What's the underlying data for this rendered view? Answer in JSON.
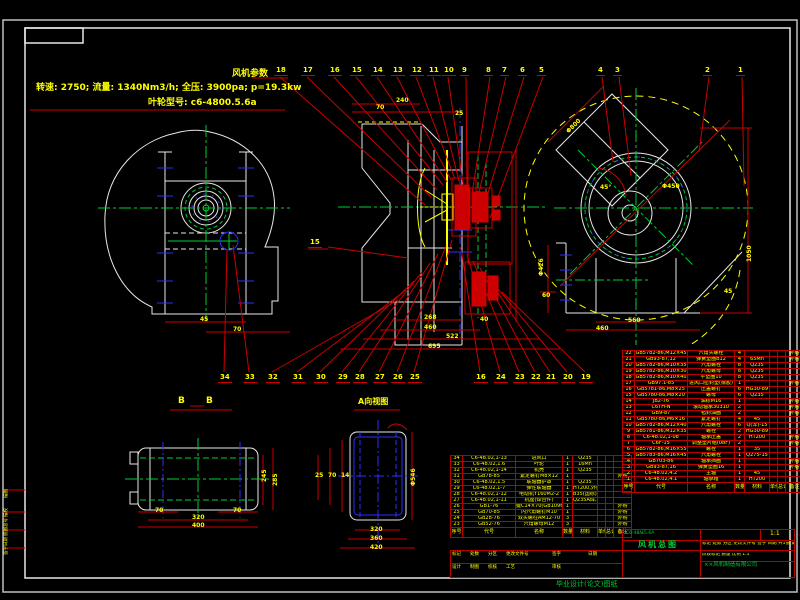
{
  "params": {
    "title": "风机参数",
    "line1": "转速: 2750; 流量: 1340Nm3/h; 全压: 3900pa; p=19.3kw",
    "line2": "叶轮型号: c6-4800.5.6a"
  },
  "section_labels": {
    "bb_left": "B",
    "bb_right": "B",
    "a_view": "A向视图"
  },
  "callout_mid": {
    "n": "15",
    "x": 308,
    "y": 238
  },
  "callouts_top": [
    {
      "n": "18",
      "x": 274,
      "tx": 425,
      "ty": 205
    },
    {
      "n": "17",
      "x": 301,
      "tx": 431,
      "ty": 197
    },
    {
      "n": "16",
      "x": 328,
      "tx": 437,
      "ty": 190
    },
    {
      "n": "15",
      "x": 350,
      "tx": 443,
      "ty": 185
    },
    {
      "n": "14",
      "x": 371,
      "tx": 447,
      "ty": 182
    },
    {
      "n": "13",
      "x": 391,
      "tx": 451,
      "ty": 180
    },
    {
      "n": "12",
      "x": 410,
      "tx": 455,
      "ty": 179
    },
    {
      "n": "11",
      "x": 427,
      "tx": 459,
      "ty": 181
    },
    {
      "n": "10",
      "x": 442,
      "tx": 463,
      "ty": 184
    },
    {
      "n": "9",
      "x": 460,
      "tx": 467,
      "ty": 188
    },
    {
      "n": "8",
      "x": 484,
      "tx": 472,
      "ty": 194
    },
    {
      "n": "7",
      "x": 500,
      "tx": 477,
      "ty": 201
    },
    {
      "n": "6",
      "x": 518,
      "tx": 483,
      "ty": 209
    },
    {
      "n": "5",
      "x": 537,
      "tx": 490,
      "ty": 218
    },
    {
      "n": "4",
      "x": 596,
      "tx": 613,
      "ty": 162
    },
    {
      "n": "3",
      "x": 613,
      "tx": 631,
      "ty": 176
    },
    {
      "n": "2",
      "x": 703,
      "tx": 699,
      "ty": 152
    },
    {
      "n": "1",
      "x": 736,
      "tx": 744,
      "ty": 186
    }
  ],
  "callouts_bottom": [
    {
      "n": "34",
      "x": 218,
      "tx": 227,
      "ty": 249
    },
    {
      "n": "33",
      "x": 243,
      "tx": 233,
      "ty": 245
    },
    {
      "n": "32",
      "x": 266,
      "tx": 398,
      "ty": 300
    },
    {
      "n": "31",
      "x": 291,
      "tx": 406,
      "ty": 290
    },
    {
      "n": "30",
      "x": 314,
      "tx": 414,
      "ty": 281
    },
    {
      "n": "29",
      "x": 336,
      "tx": 422,
      "ty": 272
    },
    {
      "n": "28",
      "x": 353,
      "tx": 430,
      "ty": 263
    },
    {
      "n": "27",
      "x": 373,
      "tx": 438,
      "ty": 254
    },
    {
      "n": "26",
      "x": 391,
      "tx": 446,
      "ty": 246
    },
    {
      "n": "25",
      "x": 408,
      "tx": 452,
      "ty": 240
    },
    {
      "n": "16",
      "x": 474,
      "tx": 461,
      "ty": 248
    },
    {
      "n": "24",
      "x": 494,
      "tx": 467,
      "ty": 254
    },
    {
      "n": "23",
      "x": 513,
      "tx": 473,
      "ty": 261
    },
    {
      "n": "22",
      "x": 529,
      "tx": 480,
      "ty": 268
    },
    {
      "n": "21",
      "x": 544,
      "tx": 487,
      "ty": 276
    },
    {
      "n": "20",
      "x": 561,
      "tx": 494,
      "ty": 284
    },
    {
      "n": "19",
      "x": 579,
      "tx": 502,
      "ty": 292
    }
  ],
  "dims": [
    {
      "t": "45",
      "x": 200,
      "y": 316
    },
    {
      "t": "70",
      "x": 233,
      "y": 326
    },
    {
      "t": "70",
      "x": 376,
      "y": 104
    },
    {
      "t": "240",
      "x": 396,
      "y": 97
    },
    {
      "t": "25",
      "x": 455,
      "y": 110
    },
    {
      "t": "268",
      "x": 424,
      "y": 314
    },
    {
      "t": "460",
      "x": 424,
      "y": 324
    },
    {
      "t": "522",
      "x": 446,
      "y": 333
    },
    {
      "t": "695",
      "x": 428,
      "y": 343
    },
    {
      "t": "40",
      "x": 480,
      "y": 316
    },
    {
      "t": "Φ800",
      "x": 565,
      "y": 130,
      "r": -45
    },
    {
      "t": "45°",
      "x": 600,
      "y": 184
    },
    {
      "t": "Φ450",
      "x": 662,
      "y": 183
    },
    {
      "t": "Φ426",
      "x": 538,
      "y": 276,
      "r": -90
    },
    {
      "t": "60",
      "x": 542,
      "y": 292
    },
    {
      "t": "560",
      "x": 628,
      "y": 317
    },
    {
      "t": "460",
      "x": 596,
      "y": 325
    },
    {
      "t": "1050",
      "x": 746,
      "y": 262,
      "r": -90
    },
    {
      "t": "45",
      "x": 724,
      "y": 288
    },
    {
      "t": "245",
      "x": 261,
      "y": 482,
      "r": -90
    },
    {
      "t": "285",
      "x": 272,
      "y": 486,
      "r": -90
    },
    {
      "t": "70",
      "x": 155,
      "y": 507
    },
    {
      "t": "320",
      "x": 192,
      "y": 514
    },
    {
      "t": "400",
      "x": 192,
      "y": 522
    },
    {
      "t": "70",
      "x": 233,
      "y": 507
    },
    {
      "t": "25",
      "x": 315,
      "y": 472
    },
    {
      "t": "70",
      "x": 328,
      "y": 472
    },
    {
      "t": "14",
      "x": 341,
      "y": 472
    },
    {
      "t": "Φ546",
      "x": 410,
      "y": 486,
      "r": -90
    },
    {
      "t": "320",
      "x": 370,
      "y": 526
    },
    {
      "t": "360",
      "x": 370,
      "y": 535
    },
    {
      "t": "420",
      "x": 370,
      "y": 544
    }
  ],
  "bom_headers": [
    "序号",
    "代号",
    "名称",
    "数量",
    "材料",
    "单件",
    "总计",
    "备注"
  ],
  "bom_right": [
    [
      "22",
      "GB5782-86,M12×45",
      "六角头螺栓",
      "4",
      "",
      "",
      "",
      "外购"
    ],
    [
      "21",
      "GB93-87,12",
      "弹簧垫圈B12",
      "4",
      "65Mn",
      "",
      "",
      "外购"
    ],
    [
      "20",
      "GB5782-86,M10×35",
      "六角螺栓",
      "8",
      "Q235",
      "",
      "",
      ""
    ],
    [
      "19",
      "GB5782-86,M10×30",
      "六角螺母",
      "8",
      "Q235",
      "",
      "",
      ""
    ],
    [
      "18",
      "GB5782-86,M10×40",
      "平垫圈10",
      "8",
      "Q235",
      "",
      "",
      ""
    ],
    [
      "17",
      "GB97.1-85",
      "进风口密封垫(橡胶)",
      "1",
      "",
      "",
      "",
      "外购"
    ],
    [
      "16",
      "GB5781-86,M8×25",
      "压盖螺钉",
      "6",
      "HG30-89",
      "",
      "",
      ""
    ],
    [
      "15",
      "GB5780-86,M8×20",
      "螺母",
      "6",
      "Q235",
      "",
      "",
      ""
    ],
    [
      "14",
      "JB2-76",
      "油标M16",
      "1",
      "",
      "",
      "",
      "外购"
    ],
    [
      "13",
      "C6TH-N",
      "滚动轴承30310",
      "2",
      "",
      "",
      "",
      "外购"
    ],
    [
      "12",
      "GB9-87",
      "毡封油圈",
      "2",
      "",
      "",
      "",
      "外购"
    ],
    [
      "11",
      "GB5780-86,M6×16",
      "紧定螺钉",
      "4",
      "45",
      "",
      "",
      ""
    ],
    [
      "10",
      "GB5782-86,M12×40",
      "六角螺栓",
      "6",
      "Q(淬)-15",
      "",
      "",
      ""
    ],
    [
      "9",
      "GB5781-86,M12×35",
      "螺栓",
      "2",
      "HG30-89",
      "",
      "",
      ""
    ],
    [
      "8",
      "C6-48.02,1-08",
      "轴承压盖",
      "2",
      "HT200",
      "",
      "",
      "外购"
    ],
    [
      "7",
      "C6F-15",
      "调整垫片组(08F)",
      "2",
      "",
      "",
      "",
      "外购"
    ],
    [
      "6",
      "GB5782-86,M16×55",
      "螺栓",
      "1",
      "35",
      "",
      "",
      ""
    ],
    [
      "5",
      "GB5783-86,M16×45",
      "六角螺栓",
      "1",
      "Q275-15",
      "",
      "",
      ""
    ],
    [
      "4",
      "GB703-86",
      "轴承挡圈",
      "1",
      "",
      "",
      "",
      "外购"
    ],
    [
      "3",
      "GB93-87,16",
      "弹簧垫圈16",
      "1",
      "",
      "",
      "",
      "外购"
    ],
    [
      "2",
      "C6-48.02,4.2",
      "主轴",
      "1",
      "45",
      "",
      "",
      ""
    ],
    [
      "1",
      "C6-48.02,4.1",
      "轴承箱",
      "1",
      "HT200",
      "",
      "",
      ""
    ]
  ],
  "bom_left": [
    [
      "34",
      "C6-48.02,1-13",
      "进风口",
      "1",
      "Q235",
      "",
      "",
      ""
    ],
    [
      "33",
      "C6-48.02,1.6",
      "叶轮",
      "1",
      "16Mn",
      "",
      "",
      ""
    ],
    [
      "32",
      "C6-48.02,1-14",
      "机壳",
      "1",
      "Q235",
      "",
      "",
      ""
    ],
    [
      "31",
      "GB78-85",
      "紧定螺钉M8×12",
      "1",
      "",
      "",
      "",
      "外购"
    ],
    [
      "30",
      "C6-48.02,1.5",
      "联轴器护罩",
      "1",
      "Q235",
      "",
      "",
      ""
    ],
    [
      "29",
      "C6-48.02,1-7",
      "弹性联轴器",
      "1",
      "HT200,外购-b",
      "",
      "",
      ""
    ],
    [
      "28",
      "C6-48.02,1-12",
      "电动机Y160M2-2",
      "1",
      "B35(国标)-4",
      "",
      "",
      ""
    ],
    [
      "27",
      "C6-48.02,1-11",
      "机座(焊合件)",
      "1",
      "Q235A焊,3-4",
      "",
      "",
      ""
    ],
    [
      "26",
      "GB1-76",
      "键C14×70(GB1096-79)",
      "1",
      "",
      "",
      "",
      "外购"
    ],
    [
      "25",
      "GB70-85",
      "内六角螺钉M10",
      "1",
      "",
      "",
      "",
      "外购"
    ],
    [
      "24",
      "GB28-76",
      "双头螺柱AM12-70",
      "3",
      "",
      "",
      "",
      "外购"
    ],
    [
      "23",
      "GB52-76",
      "六角螺母M12",
      "3",
      "",
      "",
      "",
      "外购"
    ]
  ],
  "title_block": {
    "model": "C6-48№5.6A",
    "title": "风机总图",
    "scale": "1:1",
    "info_row": "标记 处数 分区 更改文件号 签字 日期  共1张 第1张",
    "stage_row": "阶段标记  质量  比例 1:1",
    "company": "××风机制造有限公司",
    "sig_header": [
      "标记",
      "处数",
      "分区",
      "更改文件号",
      "签字",
      "日期"
    ],
    "sig_row": [
      "设计",
      "制图",
      "校核",
      "工艺",
      "审核",
      ""
    ]
  },
  "rev_strip": [
    "描图",
    "描校",
    "底图总号",
    "签字日期"
  ],
  "bottom_note": "毕业设计(论文)图纸"
}
